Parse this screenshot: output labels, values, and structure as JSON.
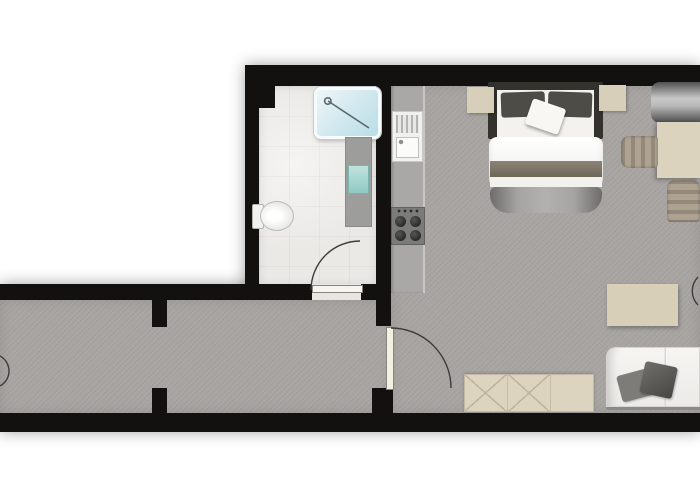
{
  "scene": {
    "type": "apartment-floor-plan",
    "width": 700,
    "height": 500,
    "background": "#ffffff"
  },
  "palette": {
    "wall": "#121110",
    "floor_main": "#a7a4a1",
    "floor_bath": "#eae9e6",
    "furniture_beige": "#dcd3be",
    "shower_glass": "#cfe7ee",
    "sink_teal": "#8cc9c1",
    "textile_dark": "#4e4c47",
    "sofa_white": "#f3f2ef",
    "arc_stroke": "#3c3c3a"
  },
  "backdrops": [
    {
      "name": "plan-shadow-upper",
      "style": "left:245px;top:65px;width:455px;height:235px"
    },
    {
      "name": "plan-shadow-lower",
      "style": "left:0px;top:284px;width:700px;height:148px"
    }
  ],
  "rooms": [
    {
      "name": "bathroom-floor",
      "style": "left:259px;top:86px;width:117px;height:199px"
    },
    {
      "name": "kitchen-living-floor",
      "style": "left:391px;top:86px;width:309px;height:327px"
    },
    {
      "name": "hallway-floor",
      "style": "left:0px;top:300px;width:391px;height:113px"
    },
    {
      "name": "bathroom-door-threshold",
      "style": "left:312px;top:284px;width:49px;height:16px;background:#e7e6e3"
    }
  ],
  "walls": [
    {
      "name": "top-wall",
      "style": "left:245px;top:65px;width:455px;height:21px"
    },
    {
      "name": "bathroom-west-wall",
      "style": "left:245px;top:65px;width:14px;height:220px"
    },
    {
      "name": "bathroom-corner-block",
      "style": "left:245px;top:65px;width:30px;height:43px"
    },
    {
      "name": "central-vertical-wall",
      "style": "left:376px;top:65px;width:15px;height:261px"
    },
    {
      "name": "door-south-stub",
      "style": "left:372px;top:388px;width:21px;height:27px"
    },
    {
      "name": "hallway-north-wall",
      "style": "left:0px;top:284px;width:312px;height:16px"
    },
    {
      "name": "bathroom-door-notch",
      "style": "left:361px;top:284px;width:15px;height:16px"
    },
    {
      "name": "hall-divider-north-stub",
      "style": "left:152px;top:284px;width:15px;height:43px"
    },
    {
      "name": "hall-divider-south-stub",
      "style": "left:152px;top:388px;width:15px;height:27px"
    },
    {
      "name": "bottom-wall",
      "style": "left:0px;top:413px;width:700px;height:19px"
    }
  ],
  "doors": [
    {
      "name": "bathroom-door",
      "leaf_style": "left:312px;top:285px;width:49px;height:6px;background:#f5f4ef;border:1px solid #86867f",
      "arc_path": "M 311 290 A 49 49 0 0 1 360 241"
    },
    {
      "name": "hallway-living-door",
      "leaf_style": "left:386px;top:327px;width:6px;height:61px;background:#f2f0e2;border:1px solid #86867f",
      "arc_path": "M 391 328 A 60 60 0 0 1 451 388"
    },
    {
      "name": "entry-door-swing-fragment",
      "arc_path": "M 0 356 A 17 17 0 0 1 0 386"
    },
    {
      "name": "right-edge-door-swing-fragment",
      "arc_path": "M 698 277 A 20 20 0 0 0 698 305"
    }
  ],
  "bathroom": {
    "shower": {
      "style": "left:314px;top:87px;width:61px;height:46px;background:linear-gradient(135deg,#eff6f8,#cfe7ee 55%,#b9dde8);border:3px solid #f7fbfb;border-radius:7px;box-shadow:0 0 0 1px #c7cdcd,1px 2px 4px rgba(0,0,0,0.25)"
    },
    "shower_glass_path": "M 328 101 L 369 128 M 331 101 A 3.2 3.2 0 1 1 324.6 101 A 3.2 3.2 0 1 1 331 101",
    "vanity": {
      "style": "left:345px;top:137px;width:27px;height:90px;background:#9d9d9b;box-shadow:inset 0 0 0 1px #8a8a88"
    },
    "vanity_sink": {
      "style": "left:348px;top:165px;width:21px;height:29px;background:linear-gradient(180deg,#c2e5df,#8cc9c1);box-shadow:inset 0 0 0 1px #79b4ad"
    },
    "toilet_tank": {
      "style": "left:252px;top:204px;width:10px;height:23px;background:#f1f1ef;border:1px solid #b3b3b1;border-radius:2px"
    },
    "toilet_bowl": {
      "style": "left:260px;top:201px;width:32px;height:28px;background:radial-gradient(ellipse at 42% 50%,#ffffff 25%,#ededeb 60%,#d8d8d6);border:1px solid #bcbcba;border-radius:50%"
    }
  },
  "kitchen": {
    "counter": {
      "style": "left:391px;top:86px;width:34px;height:207px;background:#a9a8a6;box-shadow:inset -2px 0 0 #c8c7c5,inset 2px 0 2px rgba(0,0,0,0.18)"
    },
    "sink_unit": {
      "style": "left:392px;top:111px;width:31px;height:51px;background:#f1f1ef;box-shadow:inset 0 0 0 1px #c8c8c6"
    },
    "drainer": {
      "style": "left:396px;top:115px;width:23px;height:18px;background:repeating-linear-gradient(90deg,#b4b4b2 0 2px,#e8e8e6 2px 5px)"
    },
    "basin": {
      "style": "left:396px;top:137px;width:23px;height:21px;background-color:#fbfbf9;box-shadow:inset 0 0 0 1px #c0c0be"
    },
    "stove": {
      "style": "left:391px;top:207px;width:34px;height:38px;background-color:#7b7b79;box-shadow:inset 0 0 0 1px #61615f"
    }
  },
  "bedroom": {
    "bed_frame": {
      "style": "left:488px;top:82px;width:115px;height:57px;background:#34322d;border-radius:2px"
    },
    "bed_inner": {
      "style": "left:497px;top:90px;width:97px;height:49px;background:#f3f2ef"
    },
    "pillow_left": {
      "style": "left:501px;top:92px;width:44px;height:25px;background:#4e4c47;border-radius:3px;transform:rotate(-2deg)"
    },
    "pillow_right": {
      "style": "left:548px;top:92px;width:44px;height:25px;background:#4e4c47;border-radius:3px;transform:rotate(2deg)"
    },
    "pillow_white": {
      "style": "left:528px;top:103px;width:35px;height:27px;background:#f8f7f4;border-radius:3px;transform:rotate(19deg);box-shadow:1px 2px 3px rgba(0,0,0,0.35)"
    },
    "duvet": {
      "style": "left:489px;top:137px;width:114px;height:50px;background:linear-gradient(180deg,#ffffff,#ecedea);border-radius:8px;box-shadow:inset 0 -5px 7px rgba(0,0,0,0.10)"
    },
    "blanket_taupe": {
      "style": "left:490px;top:161px;width:112px;height:16px;background:linear-gradient(180deg,#8b8375,#6e6758)"
    },
    "sheet_fold": {
      "style": "left:490px;top:177px;width:112px;height:10px;background:#f2f1ee"
    },
    "footer_blanket": {
      "style": "left:490px;top:187px;width:112px;height:26px;background:linear-gradient(90deg,#6d6c6a,#a5a4a2 25%,#b2b1af 50%,#a5a4a2 75%,#6d6c6a);border-radius:6px 6px 18px 18px"
    },
    "nightstand_left": {
      "style": "left:467px;top:87px;width:27px;height:26px;background:#d8cfbb;box-shadow:1px 1px 3px rgba(0,0,0,0.3)"
    },
    "nightstand_right": {
      "style": "left:599px;top:85px;width:27px;height:26px;background:#d8cfbb;box-shadow:1px 1px 3px rgba(0,0,0,0.3)"
    },
    "bolster_roll": {
      "style": "left:651px;top:82px;width:49px;height:41px;background:linear-gradient(180deg,#505050,#c8c8c8 40%,#b9b9b9 58%,#4a4a4a);border-radius:9px 0 0 9px"
    },
    "dining_table": {
      "style": "left:657px;top:122px;width:43px;height:56px;background:#dcd3be;box-shadow:-2px 2px 4px rgba(0,0,0,0.28)"
    },
    "chair_west": {
      "style": "left:621px;top:136px;width:37px;height:32px;background:repeating-linear-gradient(90deg,#95897a 0 4px,#aea293 4px 10px);border-radius:8px 4px 4px 8px;box-shadow:inset 0 0 3px rgba(0,0,0,0.3)"
    },
    "chair_south": {
      "style": "left:667px;top:180px;width:33px;height:42px;background:repeating-linear-gradient(180deg,#95897a 0 4px,#aea293 4px 10px);border-radius:8px 8px 4px 4px;box-shadow:inset 0 0 3px rgba(0,0,0,0.3)"
    }
  },
  "living": {
    "coffee_table": {
      "style": "left:607px;top:284px;width:71px;height:42px;background:#d8cfb9;box-shadow:1px 2px 4px rgba(0,0,0,0.3)"
    },
    "sofa": {
      "style": "left:606px;top:347px;width:94px;height:60px;background:linear-gradient(90deg,transparent 0 62%,#d8d7d4 62% 64%,transparent 64%),linear-gradient(180deg,#f6f5f2,#ebeae7);border-radius:10px 0 0 3px;box-shadow:inset 0 0 0 1px #d6d5d2,inset 12px 0 10px -8px rgba(0,0,0,0.18);border-bottom:3px solid #8b8a88"
    },
    "sofa_pillow_left": {
      "style": "left:619px;top:372px;width:31px;height:27px;background:#7d7c78;transform:rotate(-15deg);border-radius:3px;box-shadow:1px 1px 2px rgba(0,0,0,0.3)"
    },
    "sofa_pillow_right": {
      "style": "left:642px;top:364px;width:33px;height:32px;background:linear-gradient(135deg,#716f6b,#474643);transform:rotate(12deg);border-radius:3px;box-shadow:1px 1px 2px rgba(0,0,0,0.3)"
    },
    "sideboard": {
      "style": "left:464px;top:374px;width:130px;height:38px;background:#ddd4bf;box-shadow:inset 0 0 0 1px #c2b9a4,0 -1px 3px rgba(0,0,0,0.18)",
      "sections": [
        {
          "pattern": "cross"
        },
        {
          "pattern": "cross"
        },
        {
          "pattern": "plain"
        }
      ]
    }
  }
}
